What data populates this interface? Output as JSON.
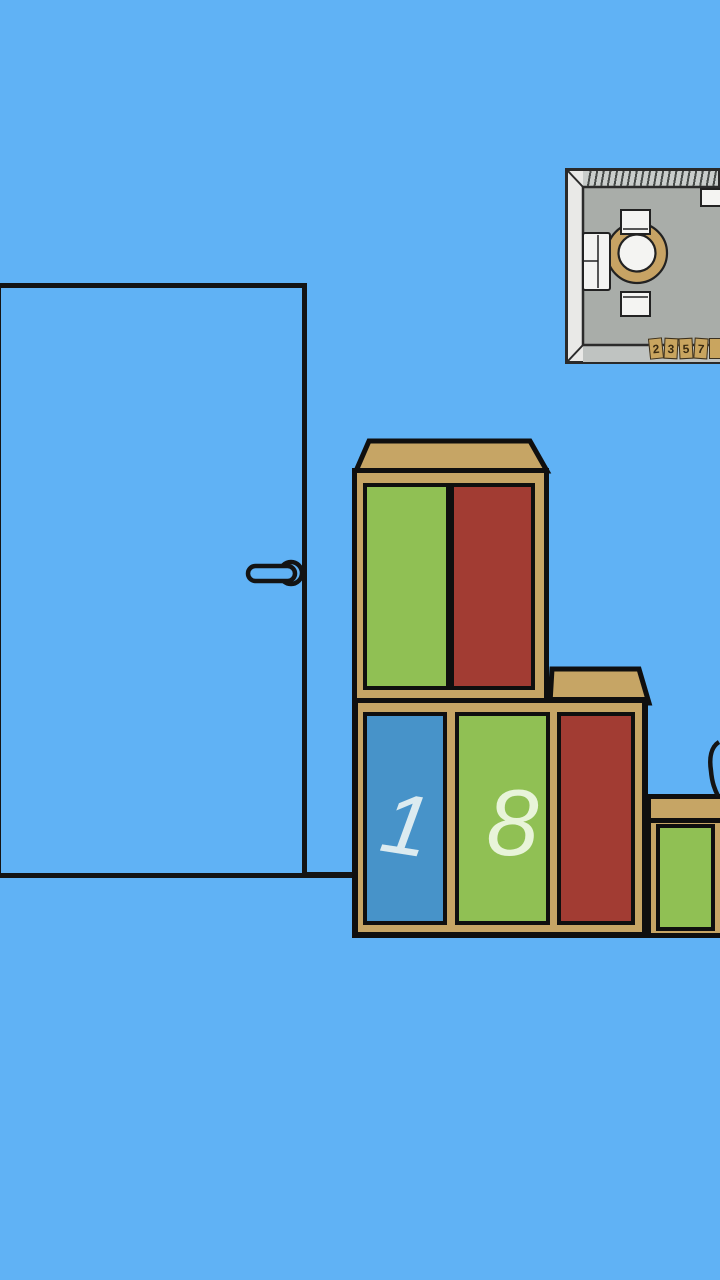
{
  "scene": {
    "description": "Cartoon escape-room wall: closed door, framed floor-plan map, wooden shelves with colored sliding panels",
    "background_color": "#60b2f5"
  },
  "colors": {
    "outline": "#141414",
    "wood": "#c6a565",
    "panel_green": "#90c054",
    "panel_red": "#a23c33",
    "panel_blue": "#4793c9",
    "digit_on_blue": "#dcebf0",
    "digit_on_green": "#e8f4d9",
    "map_wall": "#c9cdcb",
    "map_wall_left": "#e9e9e7",
    "map_wall_bottom": "#bfc3c1",
    "map_floor": "#a9ada9",
    "map_furniture_white": "#f4f4f2",
    "map_table_tan": "#c7a364",
    "tile_wood": "#c9a55f",
    "tile_digit": "#3a2b12"
  },
  "map": {
    "tiles": [
      {
        "label": "2"
      },
      {
        "label": "3"
      },
      {
        "label": "5"
      },
      {
        "label": "7"
      },
      {
        "label": ""
      }
    ]
  },
  "shelves": {
    "upper": {
      "panels": [
        {
          "color": "green",
          "digit": ""
        },
        {
          "color": "red",
          "digit": ""
        }
      ]
    },
    "lower": {
      "panels": [
        {
          "color": "blue",
          "digit": "1"
        },
        {
          "color": "green",
          "digit": "8"
        },
        {
          "color": "red",
          "digit": ""
        }
      ]
    },
    "side": {
      "panels": [
        {
          "color": "green",
          "digit": ""
        }
      ]
    }
  }
}
